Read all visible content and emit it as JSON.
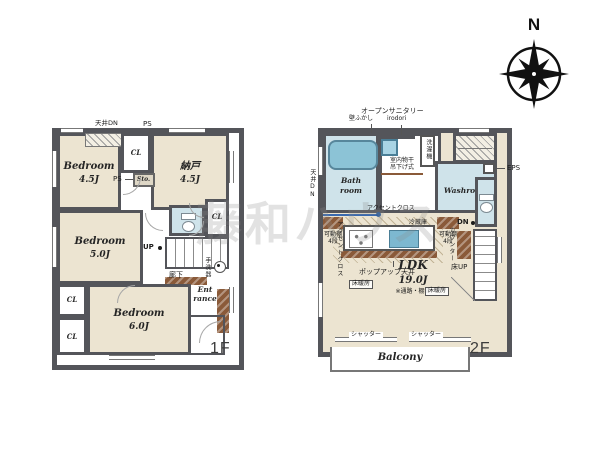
{
  "watermark": "藤和ハウス",
  "compass": {
    "north": "N"
  },
  "f1": {
    "floor": "1F",
    "ceiling_dn": "天井DN",
    "ps_top": "PS",
    "ps_mid": "PS",
    "cl_top": "CL",
    "sto": "Sto.",
    "bedroom1": {
      "name": "Bedroom",
      "size": "4.5J"
    },
    "nando": {
      "name": "納戸",
      "size": "4.5J"
    },
    "bedroom2": {
      "name": "Bedroom",
      "size": "5.0J"
    },
    "bedroom3": {
      "name": "Bedroom",
      "size": "6.0J"
    },
    "cl_right": "CL",
    "cl_left_upper": "CL",
    "cl_left_lower": "CL",
    "up": "UP",
    "hallway": "廊下",
    "hand_wash": "手洗器",
    "entrance_line1": "Ent",
    "entrance_line2": "rance"
  },
  "f2": {
    "floor": "2F",
    "open_sanitary": "オープンサニタリー",
    "open_sanitary_sub": "irodori",
    "wall_fukashi": "壁ふかし",
    "washer": "洗濯機",
    "ceiling_dn": "天井DN",
    "bath_line1": "Bath",
    "bath_line2": "room",
    "washroom": "Washroom",
    "drying_line1": "室内物干",
    "drying_line2": "吊下げ式",
    "eps": "EPS",
    "shelf_left_line1": "可動棚",
    "shelf_left_line2": "4段",
    "shelf_right_line1": "可動棚",
    "shelf_right_line2": "4段",
    "fridge": "冷蔵庫",
    "accent_top": "アクセントクロス",
    "accent_left": "アクセントクロス",
    "popup": "ポップアップ天井",
    "counter": "カウンター",
    "dn": "DN",
    "floor_up": "床UP",
    "ldk": {
      "name": "LDK",
      "size": "19.0J",
      "note": "※通路・棚含"
    },
    "heating_left": "床暖房",
    "heating_right": "床暖房",
    "shutter_left": "シャッター",
    "shutter_right": "シャッター",
    "balcony": "Balcony"
  }
}
